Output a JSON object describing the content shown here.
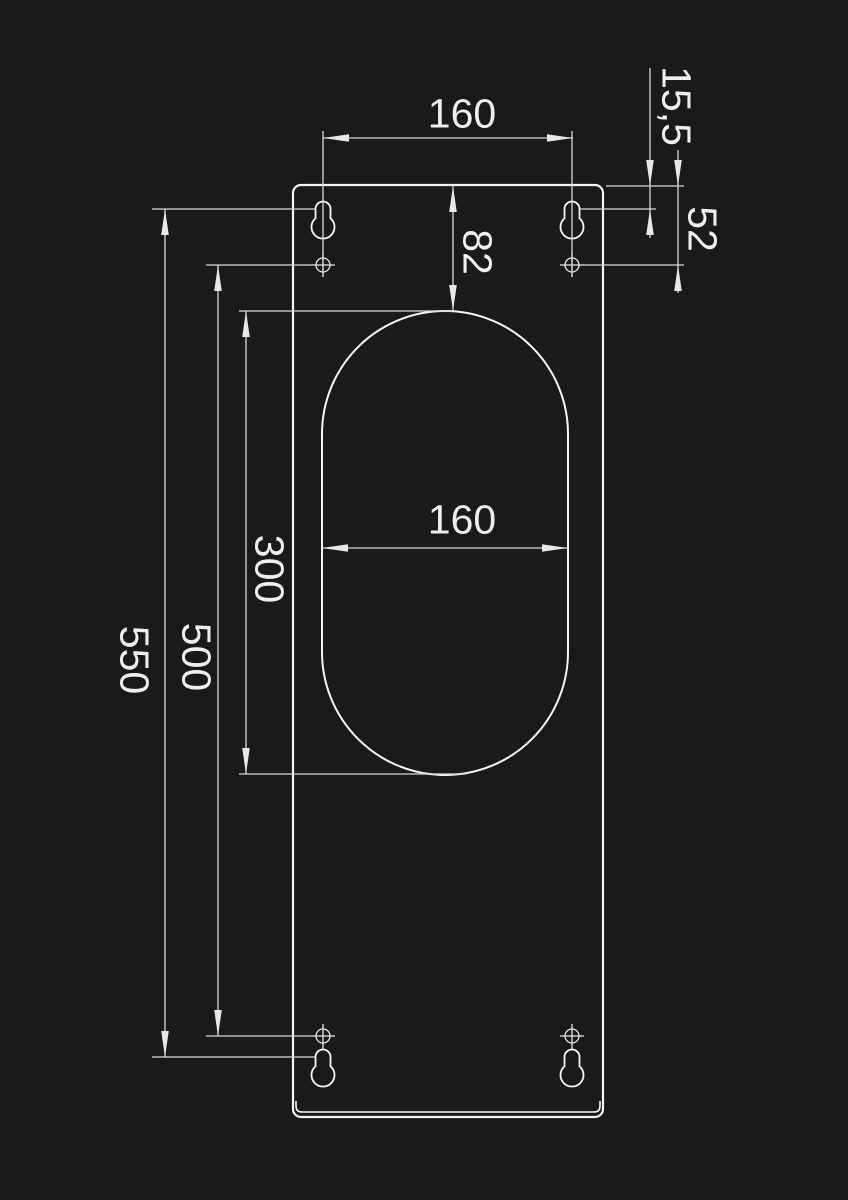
{
  "canvas": {
    "background": "#1a1a1a",
    "part_line_color": "#f5f5f5",
    "dim_line_color": "#d8d8d8",
    "text_color": "#efefef"
  },
  "drawing": {
    "type": "technical-dimension-drawing",
    "subject": "rectangular mounting plate with obround cutout, keyhole slots and hole center marks",
    "labels": {
      "top_spacing": "160",
      "slot_offset": "15,5",
      "hole_offset": "52",
      "cutout_offset": "82",
      "cutout_width": "160",
      "cutout_height": "300",
      "hole_spacing": "500",
      "slot_spacing": "550"
    }
  }
}
